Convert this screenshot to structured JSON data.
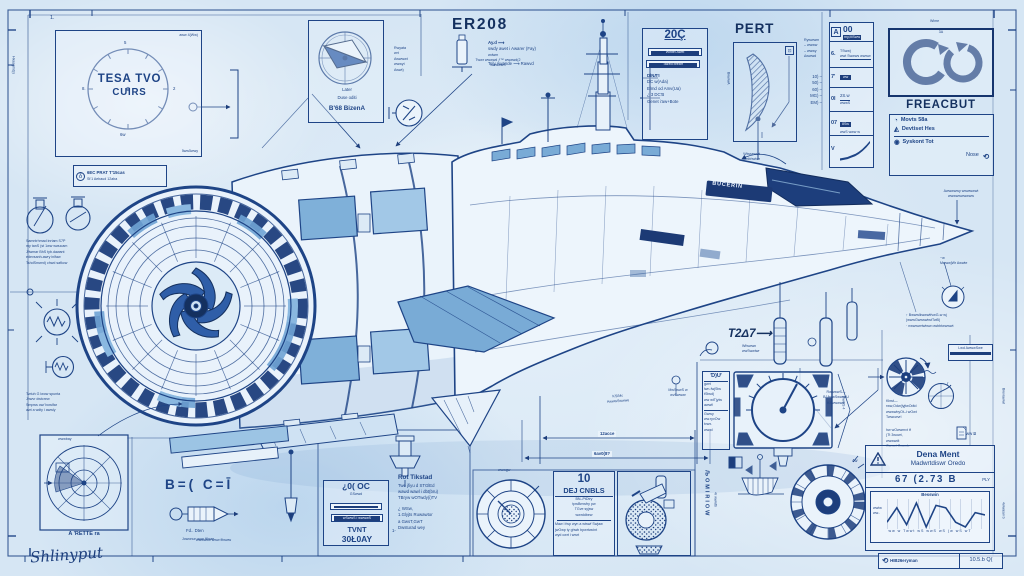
{
  "sheet": {
    "signature": "Shlinyput",
    "edge_left_vertical": "Hkasgmd(s",
    "edge_right_vertical_1": "Bwvrawwl",
    "edge_right_vertical_2": "4wwasw b",
    "corner_mark": "1.",
    "bottom_note": "wwwwtiw www fitwww"
  },
  "dial": {
    "title1": "TESA TVO",
    "title2": "CUIRS",
    "corner_top": "aww 4(Ww)",
    "corner_bottom": "5ww5wwy",
    "tick_top": "5",
    "tick_right": "2",
    "tick_left": "8.",
    "tick_bottom": "6w"
  },
  "chip": {
    "badge": "δ",
    "line1": "6EC PRAT T'15cas",
    "line2": "St'1 Aebaud  12aba"
  },
  "flask_notes": {
    "lines": [
      "Samntrhmad  inrtam S7P",
      "my tanS (st  1ww wwucam",
      "Jfiwmar BhS  tyb.dawant",
      "edevsanh-awry   inlfaw",
      "TshdSmwrd) chwd safkcw"
    ]
  },
  "coil_notes": {
    "lines": [
      "Twtuh G  lwow  spunta",
      "Jhwvr  dwtcrew",
      "Smpws ow/ bowlfar",
      "awt a wdty i awwly"
    ]
  },
  "radar": {
    "corner": "wwwbay",
    "label": "A 'RETTE ra"
  },
  "compass": {
    "line1": "Later",
    "line2": "Duse oditi",
    "line3": "B'68 BizenA"
  },
  "midcol": {
    "lines": [
      "Rwyata",
      "wrt",
      "Awwwwt",
      "wwwyt",
      "Awwt)"
    ]
  },
  "er208": {
    "title": "ER208",
    "note_top": "Ay.d ⟶",
    "note1": "swdy awet i Awarer (Fay)",
    "note1b": "wdwm",
    "note2": "Tely Awande ⟶ Rawvd"
  },
  "z0q": {
    "title": "20Ç",
    "bar1": "Wintel Awel",
    "bar2": "Tazed breafr",
    "lines": [
      "DÌNЛ'I",
      "DC w(Ada)",
      "Elmd od Amv(Ua)",
      "¿ 3 DC'B",
      "Genet i'aw+Bote"
    ]
  },
  "pert": {
    "title": "PERT",
    "icon": "⊡",
    "side": "BwwwA"
  },
  "rightticks": {
    "arrows": [
      "Rywwwm",
      "– wwww",
      "– wwwy",
      "Δwwwd"
    ],
    "rows": [
      "10) –",
      "50) –",
      "60) –",
      "MG) –",
      "EM) –"
    ]
  },
  "trtable": {
    "header_icon": "A",
    "header": "00",
    "header_sub": "my,MSww",
    "rows": [
      {
        "key": "6.",
        "l1": "TSww)",
        "l2": "wwt Swwws wwww"
      },
      {
        "key": "7'",
        "l1": "ww",
        "l2": ""
      },
      {
        "key": "0l",
        "l1": "2S.w",
        "l2": "wwwS"
      },
      {
        "key": "07",
        "l1": "8Sw",
        "l2": "wwS www w"
      },
      {
        "key": "V",
        "l1": "",
        "l2": ""
      }
    ],
    "curve": [
      1,
      2,
      3,
      5,
      7,
      10,
      14,
      19,
      25
    ]
  },
  "freacbut": {
    "tiny_top": "Wime",
    "box_tag": "3A",
    "title": "FREACBUT",
    "items": [
      {
        "icon": "◔",
        "label": "Movts 58a"
      },
      {
        "icon": "◭",
        "label": "Devtiset Hes"
      },
      {
        "icon": "◉",
        "label": "Syskont Tot"
      }
    ],
    "footer": "Nose",
    "footer_icon": "⟲"
  },
  "ship": {
    "vent_text": "BUCERIN",
    "callout_top": "Twwr wwwwd ƒ™ wwwwd(2",
    "callout_top2": "wwwwwS",
    "callout_mid1": "Wlwsewwt",
    "callout_mid2": "awtbhwtwr",
    "t2d7": "T2Δ7⟶",
    "t2d7_sub1": "Wfwwwn",
    "t2d7_sub2": "wwSwwtwr",
    "nose_top1": "Awwwwwy wwwwwwt",
    "nose_top2": "wwwwwwwwww",
    "nose_mid1": "~w",
    "nose_mid2": "MwwwjWr Awwte",
    "nose_low1": "↑ BwwwlkwwwtfvwG-w wj",
    "nose_low2": "(wwwGwwswtwtTwB)",
    "nose_low3": "· nwwwwrtwtww owbbtwwwwt"
  },
  "dims": {
    "d1": "12acce",
    "d2": "6av0(8?",
    "c1a": "KS/Mc",
    "c1b": "AwwwSwwwe",
    "c2a": "MwSwwS w",
    "c2b": "wvSwwwr",
    "c3a": "RwwwwS—",
    "c3b": "BJAwwSwwwrU",
    "c3c": "KSwwwww",
    "diamond": "GwwS 4"
  },
  "formulas": {
    "eq": "B=( C=Ī",
    "bolt1": "Fd.. Dten",
    "bolt2": "Jowonun won Klnae"
  },
  "ocbox": {
    "title": "¿0( OC",
    "sub": "GSwwd",
    "bar2": "wSwwS i wwwwS",
    "l1": "TVNT",
    "l2": "30Ł0AY"
  },
  "rotblock": {
    "title": "Rot Tikstad",
    "lines": [
      "Twe jfiyu d STGlEd",
      "wawd wawl i dbt(bru)",
      "TBryw wOTwdy(i)TV"
    ],
    "list": [
      "¿ WSw,",
      "1.Glyjts Ruwawtor",
      "a GwsT,GwT",
      "Dwsturad wey"
    ],
    "stray": "1-"
  },
  "gaugebc": {
    "top": "wwwgw"
  },
  "dej": {
    "num": "10",
    "name": "DEJ CNBLS",
    "lines1": [
      "BN–PtDtry",
      "tpwBmwfry pw",
      "TGve syjsw",
      "wwrddbew"
    ],
    "lines2": [
      "Maw i fwp wyn a wtswf Swjaw",
      "jwOwp ty ghwb bpwrtwcint",
      "wyd cwrt i wwrt"
    ]
  },
  "strip": {
    "v1": "ЉOMIRIOW",
    "v2": "4r wwwtb"
  },
  "du": {
    "header": "Ɗ)Ư",
    "lines1": [
      "gwrt",
      "lwn-fwjStw",
      "tStwd)",
      "ww wtTjylw",
      "awwt!"
    ],
    "lines2": [
      "Gwwy",
      "ww.ryvOw",
      "tvwx.",
      "wwwl"
    ]
  },
  "wheel": {
    "topbox1": "Lwd AwwwSwe",
    "lines1": [
      "Kbwt—",
      "rww,Odw(lyjtwOdtd",
      "wwwwbyOt–i wOwt",
      "Twwcwvrl"
    ],
    "lines2": [
      "hw wOwwmvt tf",
      "(Tt 3wowt,",
      "wwwwdt",
      "Owwci Owwde"
    ],
    "chart_r": "r",
    "doc": "ww Ƀ",
    "tick": "4w"
  },
  "titleblock": {
    "title": "Dena Ment",
    "subtitle": "Madwrtdiswr Oredo",
    "number": "67 (2.73 B",
    "number_side": "PLY",
    "chart_title": "Besswin",
    "chart_x": "ww  w  Twwt  wS  wwS  wS  (w  wS  wT",
    "ylab1": "wwtw",
    "ylab2": "ww..",
    "values": [
      10,
      16,
      9,
      18,
      8,
      17,
      16,
      10,
      8,
      14,
      13
    ]
  },
  "footer": {
    "icon": "⟲",
    "text": "HIB26eryman",
    "right": "10.5.b Q("
  }
}
